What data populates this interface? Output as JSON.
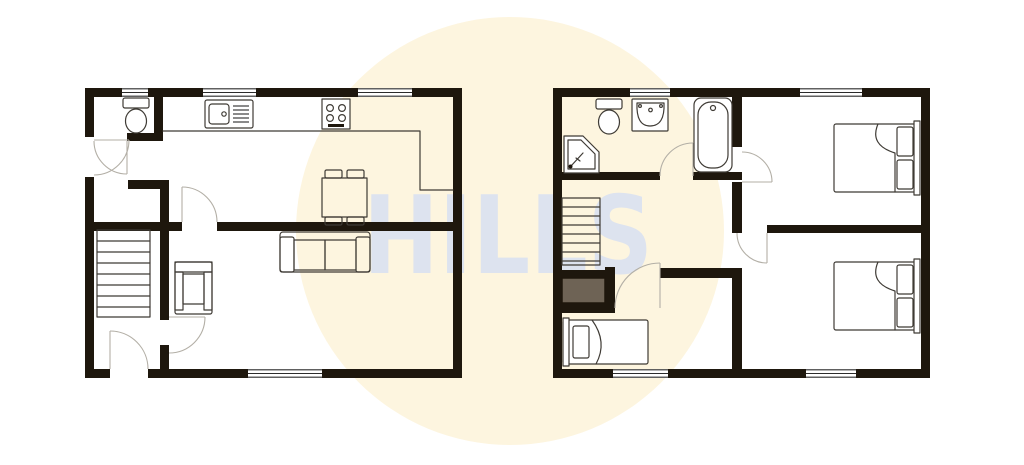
{
  "watermark": {
    "text": "HILLS"
  },
  "colors": {
    "background": "#ffffff",
    "circle": "#fdf5df",
    "watermark": "#dde3ef",
    "wall": "#1e170d",
    "line": "#3f3b35",
    "arc": "#b3afa6",
    "cupboard": "#6e6355",
    "furniture_fill": "#ffffff"
  },
  "plans": [
    {
      "id": "ground-floor",
      "rooms": [
        "wc",
        "hall",
        "kitchen-dining-room",
        "living-room",
        "stairs-lobby"
      ],
      "fixtures": [
        "toilet",
        "kitchen-sink",
        "hob",
        "kitchen-counter",
        "dining-table",
        "dining-chairs",
        "sofa",
        "armchair",
        "staircase"
      ]
    },
    {
      "id": "first-floor",
      "rooms": [
        "bathroom",
        "landing",
        "bedroom-1",
        "bedroom-2",
        "bedroom-3"
      ],
      "fixtures": [
        "toilet",
        "wash-basin",
        "corner-shower",
        "bath",
        "staircase",
        "storage-cupboard",
        "double-bed",
        "double-bed",
        "single-bed"
      ]
    }
  ]
}
